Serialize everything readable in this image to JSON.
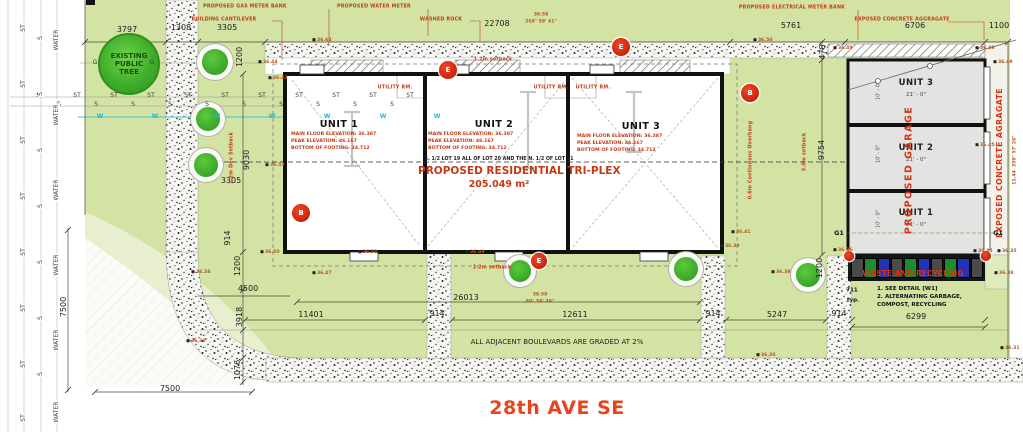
{
  "colors": {
    "site_green": "#d2e3a4",
    "pale_green": "#e7efcf",
    "accent_red": "#c23b16",
    "elev_orange": "#b5551c",
    "tree_green": "#35a82c",
    "water_cyan": "#3cc3d5",
    "garage_fill": "#e3e3e1",
    "street_orange": "#e8431c",
    "waste_gray": "#4a4a4a",
    "waste_green": "#1f8b30",
    "waste_blue": "#2233bb"
  },
  "street": {
    "name": "28th AVE SE"
  },
  "public_tree": {
    "l1": "EXISTING",
    "l2": "PUBLIC",
    "l3": "TREE"
  },
  "building": {
    "lot": "S. 1/2 LOT 19 ALL OF LOT 20 AND THE N. 1/2 OF LOT 21",
    "title": "PROPOSED RESIDENTIAL TRI-PLEX",
    "area": "205.049 m²"
  },
  "units": [
    {
      "name": "UNIT 1",
      "f": "MAIN FLOOR ELEVATION: 36.387",
      "p": "PEAK ELEVATION: 46.167",
      "b": "BOTTOM OF FOOTING: 34.712"
    },
    {
      "name": "UNIT 2",
      "f": "MAIN FLOOR ELEVATION: 36.387",
      "p": "PEAK ELEVATION: 46.167",
      "b": "BOTTOM OF FOOTING: 34.712"
    },
    {
      "name": "UNIT 3",
      "f": "MAIN FLOOR ELEVATION: 36.387",
      "p": "PEAK ELEVATION: 46.167",
      "b": "BOTTOM OF FOOTING: 34.712"
    }
  ],
  "garage": {
    "units": [
      {
        "name": "UNIT 3",
        "size": "21' - 0\""
      },
      {
        "name": "UNIT 2",
        "size": "21' - 0\""
      },
      {
        "name": "UNIT 1",
        "size": "21' - 0\""
      }
    ]
  },
  "waste": {
    "note1": "1. SEE DETAIL [W1]",
    "note2": "2. ALTERNATING GARBAGE,",
    "note3": "COMPOST, RECYCLING",
    "pattern": [
      "gray",
      "green",
      "blue",
      "gray",
      "green",
      "blue",
      "gray",
      "green",
      "blue",
      "gray"
    ]
  },
  "boulevard_note": "ALL ADJACENT BOULEVARDS ARE GRADED AT 2%",
  "labels": [
    {
      "c": "d",
      "t": "3797",
      "x": 127,
      "y": 30
    },
    {
      "c": "d",
      "t": "1308",
      "x": 181,
      "y": 28
    },
    {
      "c": "d",
      "t": "3305",
      "x": 227,
      "y": 28
    },
    {
      "c": "d",
      "t": "22708",
      "x": 497,
      "y": 24
    },
    {
      "c": "d",
      "t": "5761",
      "x": 791,
      "y": 26
    },
    {
      "c": "d",
      "t": "6706",
      "x": 915,
      "y": 26
    },
    {
      "c": "d",
      "t": "1100",
      "x": 999,
      "y": 26
    },
    {
      "c": "dv",
      "t": "1200",
      "x": 240,
      "y": 57
    },
    {
      "c": "dv",
      "t": "478",
      "x": 823,
      "y": 52
    },
    {
      "c": "dv",
      "t": "9030",
      "x": 247,
      "y": 160
    },
    {
      "c": "d",
      "t": "3305",
      "x": 231,
      "y": 181
    },
    {
      "c": "dv",
      "t": "914",
      "x": 228,
      "y": 238
    },
    {
      "c": "dv",
      "t": "1200",
      "x": 238,
      "y": 266
    },
    {
      "c": "d",
      "t": "4500",
      "x": 248,
      "y": 289
    },
    {
      "c": "dv",
      "t": "3918",
      "x": 240,
      "y": 317
    },
    {
      "c": "dv",
      "t": "1076",
      "x": 238,
      "y": 370
    },
    {
      "c": "dv",
      "t": "7500",
      "x": 64,
      "y": 307
    },
    {
      "c": "d",
      "t": "7500",
      "x": 170,
      "y": 389
    },
    {
      "c": "d",
      "t": "11401",
      "x": 311,
      "y": 315
    },
    {
      "c": "d",
      "t": "26013",
      "x": 466,
      "y": 298
    },
    {
      "c": "d",
      "t": "914",
      "x": 437,
      "y": 314
    },
    {
      "c": "d",
      "t": "12611",
      "x": 575,
      "y": 315
    },
    {
      "c": "d",
      "t": "914",
      "x": 713,
      "y": 314
    },
    {
      "c": "d",
      "t": "5247",
      "x": 777,
      "y": 315
    },
    {
      "c": "d",
      "t": "914",
      "x": 839,
      "y": 314
    },
    {
      "c": "d",
      "t": "6299",
      "x": 916,
      "y": 317
    },
    {
      "c": "dv",
      "t": "9754",
      "x": 822,
      "y": 150
    },
    {
      "c": "dv",
      "t": "1200",
      "x": 820,
      "y": 268
    },
    {
      "c": "n",
      "t": "711",
      "x": 852,
      "y": 291
    },
    {
      "c": "n",
      "t": "typ.",
      "x": 853,
      "y": 301
    },
    {
      "c": "b",
      "t": "39.58",
      "x": 541,
      "y": 16
    },
    {
      "c": "b",
      "t": "269° 59' 41\"",
      "x": 541,
      "y": 23
    },
    {
      "c": "b",
      "t": "39.58",
      "x": 540,
      "y": 296
    },
    {
      "c": "b",
      "t": "89° 59' 49\"",
      "x": 540,
      "y": 303
    },
    {
      "c": "bv",
      "t": "11.44  359° 57' 26\"",
      "x": 1016,
      "y": 160
    },
    {
      "c": "c",
      "t": "PROPOSED GAS METER BANK",
      "x": 245,
      "y": 8
    },
    {
      "c": "c",
      "t": "BUILDING CANTILEVER",
      "x": 224,
      "y": 21
    },
    {
      "c": "c",
      "t": "PROPOSED WATER METER",
      "x": 374,
      "y": 8
    },
    {
      "c": "c",
      "t": "WASHED ROCK",
      "x": 441,
      "y": 21
    },
    {
      "c": "c",
      "t": "PROPOSED ELECTRICAL METER BANK",
      "x": 792,
      "y": 9
    },
    {
      "c": "c",
      "t": "EXPOSED CONCRETE AGGRAGATE",
      "x": 902,
      "y": 21
    },
    {
      "c": "c",
      "t": "1.2m setback",
      "x": 493,
      "y": 61
    },
    {
      "c": "c",
      "t": "1.2m setback",
      "x": 492,
      "y": 269
    },
    {
      "c": "cv",
      "t": "0.6m Continuous Overhang",
      "x": 752,
      "y": 160
    },
    {
      "c": "cv",
      "t": "3.0m setback",
      "x": 806,
      "y": 152
    },
    {
      "c": "cv",
      "t": "1.2m Dev Setback",
      "x": 233,
      "y": 158
    },
    {
      "c": "c",
      "t": "UTILITY RM.",
      "x": 395,
      "y": 89
    },
    {
      "c": "c",
      "t": "UTILITY RM.",
      "x": 551,
      "y": 89
    },
    {
      "c": "c",
      "t": "UTILITY RM.",
      "x": 593,
      "y": 89
    },
    {
      "c": "cw",
      "t": "WASTE AND RECYCLING",
      "x": 913,
      "y": 274
    },
    {
      "c": "cpv",
      "t": "PROPOSED GARAGE",
      "x": 909,
      "y": 170
    },
    {
      "c": "cev",
      "t": "EXPOSED CONCRETE AGRAGATE",
      "x": 1000,
      "y": 163
    },
    {
      "c": "g1",
      "t": "G1",
      "x": 839,
      "y": 233
    },
    {
      "c": "g1",
      "t": "G1",
      "x": 998,
      "y": 233
    },
    {
      "c": "gd",
      "t": "10' - 0\"",
      "x": 879,
      "y": 91
    },
    {
      "c": "gd",
      "t": "10' - 0\"",
      "x": 879,
      "y": 154
    },
    {
      "c": "gd",
      "t": "10' - 0\"",
      "x": 879,
      "y": 219
    },
    {
      "c": "e",
      "t": "36.64",
      "x": 322,
      "y": 41
    },
    {
      "c": "e",
      "t": "36.44",
      "x": 268,
      "y": 63
    },
    {
      "c": "e",
      "t": "36.43",
      "x": 278,
      "y": 79
    },
    {
      "c": "e",
      "t": "36.50",
      "x": 763,
      "y": 41
    },
    {
      "c": "e",
      "t": "36.49",
      "x": 843,
      "y": 49
    },
    {
      "c": "e",
      "t": "36.49",
      "x": 985,
      "y": 49
    },
    {
      "c": "e",
      "t": "36.49",
      "x": 1003,
      "y": 63
    },
    {
      "c": "e",
      "t": "36.53",
      "x": 275,
      "y": 166
    },
    {
      "c": "e",
      "t": "36.58",
      "x": 201,
      "y": 273
    },
    {
      "c": "e",
      "t": "36.41",
      "x": 741,
      "y": 233
    },
    {
      "c": "e",
      "t": "36.39",
      "x": 730,
      "y": 247
    },
    {
      "c": "e",
      "t": "36.45",
      "x": 985,
      "y": 146
    },
    {
      "c": "e",
      "t": "36.35",
      "x": 983,
      "y": 252
    },
    {
      "c": "e",
      "t": "36.35",
      "x": 1007,
      "y": 252
    },
    {
      "c": "e",
      "t": "36.36",
      "x": 843,
      "y": 251
    },
    {
      "c": "e",
      "t": "36.38",
      "x": 1004,
      "y": 274
    },
    {
      "c": "e",
      "t": "36.38",
      "x": 781,
      "y": 273
    },
    {
      "c": "e",
      "t": "36.26",
      "x": 766,
      "y": 356
    },
    {
      "c": "e",
      "t": "36.31",
      "x": 1010,
      "y": 349
    },
    {
      "c": "e",
      "t": "36.32",
      "x": 196,
      "y": 342
    },
    {
      "c": "e",
      "t": "36.50",
      "x": 270,
      "y": 253
    },
    {
      "c": "e",
      "t": "36.51",
      "x": 368,
      "y": 253
    },
    {
      "c": "e",
      "t": "36.49",
      "x": 475,
      "y": 253
    },
    {
      "c": "e",
      "t": "36.47",
      "x": 322,
      "y": 274
    },
    {
      "c": "u",
      "t": "ST",
      "x": 40,
      "y": 96
    },
    {
      "c": "u",
      "t": "ST",
      "x": 77,
      "y": 96
    },
    {
      "c": "u",
      "t": "ST",
      "x": 114,
      "y": 96
    },
    {
      "c": "u",
      "t": "ST",
      "x": 151,
      "y": 96
    },
    {
      "c": "u",
      "t": "ST",
      "x": 188,
      "y": 96
    },
    {
      "c": "u",
      "t": "ST",
      "x": 225,
      "y": 96
    },
    {
      "c": "u",
      "t": "ST",
      "x": 262,
      "y": 96
    },
    {
      "c": "u",
      "t": "ST",
      "x": 299,
      "y": 96
    },
    {
      "c": "u",
      "t": "ST",
      "x": 336,
      "y": 96
    },
    {
      "c": "u",
      "t": "ST",
      "x": 373,
      "y": 96
    },
    {
      "c": "u",
      "t": "ST",
      "x": 410,
      "y": 96
    },
    {
      "c": "u",
      "t": "S",
      "x": 59,
      "y": 105
    },
    {
      "c": "u",
      "t": "S",
      "x": 96,
      "y": 105
    },
    {
      "c": "u",
      "t": "S",
      "x": 133,
      "y": 105
    },
    {
      "c": "u",
      "t": "S",
      "x": 170,
      "y": 105
    },
    {
      "c": "u",
      "t": "S",
      "x": 207,
      "y": 105
    },
    {
      "c": "u",
      "t": "S",
      "x": 244,
      "y": 105
    },
    {
      "c": "u",
      "t": "S",
      "x": 281,
      "y": 105
    },
    {
      "c": "u",
      "t": "S",
      "x": 318,
      "y": 105
    },
    {
      "c": "u",
      "t": "S",
      "x": 355,
      "y": 105
    },
    {
      "c": "u",
      "t": "S",
      "x": 392,
      "y": 105
    },
    {
      "c": "uw",
      "t": "W",
      "x": 100,
      "y": 117
    },
    {
      "c": "uw",
      "t": "W",
      "x": 155,
      "y": 117
    },
    {
      "c": "uw",
      "t": "W",
      "x": 217,
      "y": 117
    },
    {
      "c": "uw",
      "t": "W",
      "x": 272,
      "y": 117
    },
    {
      "c": "uw",
      "t": "W",
      "x": 327,
      "y": 117
    },
    {
      "c": "uw",
      "t": "W",
      "x": 383,
      "y": 117
    },
    {
      "c": "uw",
      "t": "W",
      "x": 437,
      "y": 117
    },
    {
      "c": "u",
      "t": "G",
      "x": 95,
      "y": 63
    },
    {
      "c": "u",
      "t": "G",
      "x": 152,
      "y": 63
    },
    {
      "c": "uv",
      "t": "ST",
      "x": 24,
      "y": 28
    },
    {
      "c": "uv",
      "t": "ST",
      "x": 24,
      "y": 84
    },
    {
      "c": "uv",
      "t": "ST",
      "x": 24,
      "y": 140
    },
    {
      "c": "uv",
      "t": "ST",
      "x": 24,
      "y": 196
    },
    {
      "c": "uv",
      "t": "ST",
      "x": 24,
      "y": 252
    },
    {
      "c": "uv",
      "t": "ST",
      "x": 24,
      "y": 308
    },
    {
      "c": "uv",
      "t": "ST",
      "x": 24,
      "y": 364
    },
    {
      "c": "uv",
      "t": "ST",
      "x": 24,
      "y": 418
    },
    {
      "c": "uv",
      "t": "S",
      "x": 41,
      "y": 38
    },
    {
      "c": "uv",
      "t": "S",
      "x": 41,
      "y": 94
    },
    {
      "c": "uv",
      "t": "S",
      "x": 41,
      "y": 150
    },
    {
      "c": "uv",
      "t": "S",
      "x": 41,
      "y": 206
    },
    {
      "c": "uv",
      "t": "S",
      "x": 41,
      "y": 262
    },
    {
      "c": "uv",
      "t": "S",
      "x": 41,
      "y": 318
    },
    {
      "c": "uv",
      "t": "S",
      "x": 41,
      "y": 374
    },
    {
      "c": "uv",
      "t": "WATER",
      "x": 57,
      "y": 40
    },
    {
      "c": "uv",
      "t": "WATER",
      "x": 57,
      "y": 115
    },
    {
      "c": "uv",
      "t": "WATER",
      "x": 57,
      "y": 190
    },
    {
      "c": "uv",
      "t": "WATER",
      "x": 57,
      "y": 265
    },
    {
      "c": "uv",
      "t": "WATER",
      "x": 57,
      "y": 340
    },
    {
      "c": "uv",
      "t": "WATER",
      "x": 57,
      "y": 412
    }
  ],
  "trees": [
    {
      "x": 215,
      "y": 62,
      "r": 13
    },
    {
      "x": 208,
      "y": 119,
      "r": 12
    },
    {
      "x": 206,
      "y": 165,
      "r": 12
    },
    {
      "x": 520,
      "y": 271,
      "r": 11
    },
    {
      "x": 686,
      "y": 269,
      "r": 12
    },
    {
      "x": 808,
      "y": 275,
      "r": 12
    }
  ],
  "markers": [
    {
      "t": "E",
      "x": 448,
      "y": 70,
      "r": 9
    },
    {
      "t": "E",
      "x": 621,
      "y": 47,
      "r": 9
    },
    {
      "t": "B",
      "x": 750,
      "y": 93,
      "r": 9
    },
    {
      "t": "B",
      "x": 301,
      "y": 213,
      "r": 9
    },
    {
      "t": "E",
      "x": 539,
      "y": 261,
      "r": 8
    },
    {
      "t": "",
      "x": 849,
      "y": 256,
      "r": 5
    },
    {
      "t": "",
      "x": 986,
      "y": 256,
      "r": 5
    }
  ]
}
